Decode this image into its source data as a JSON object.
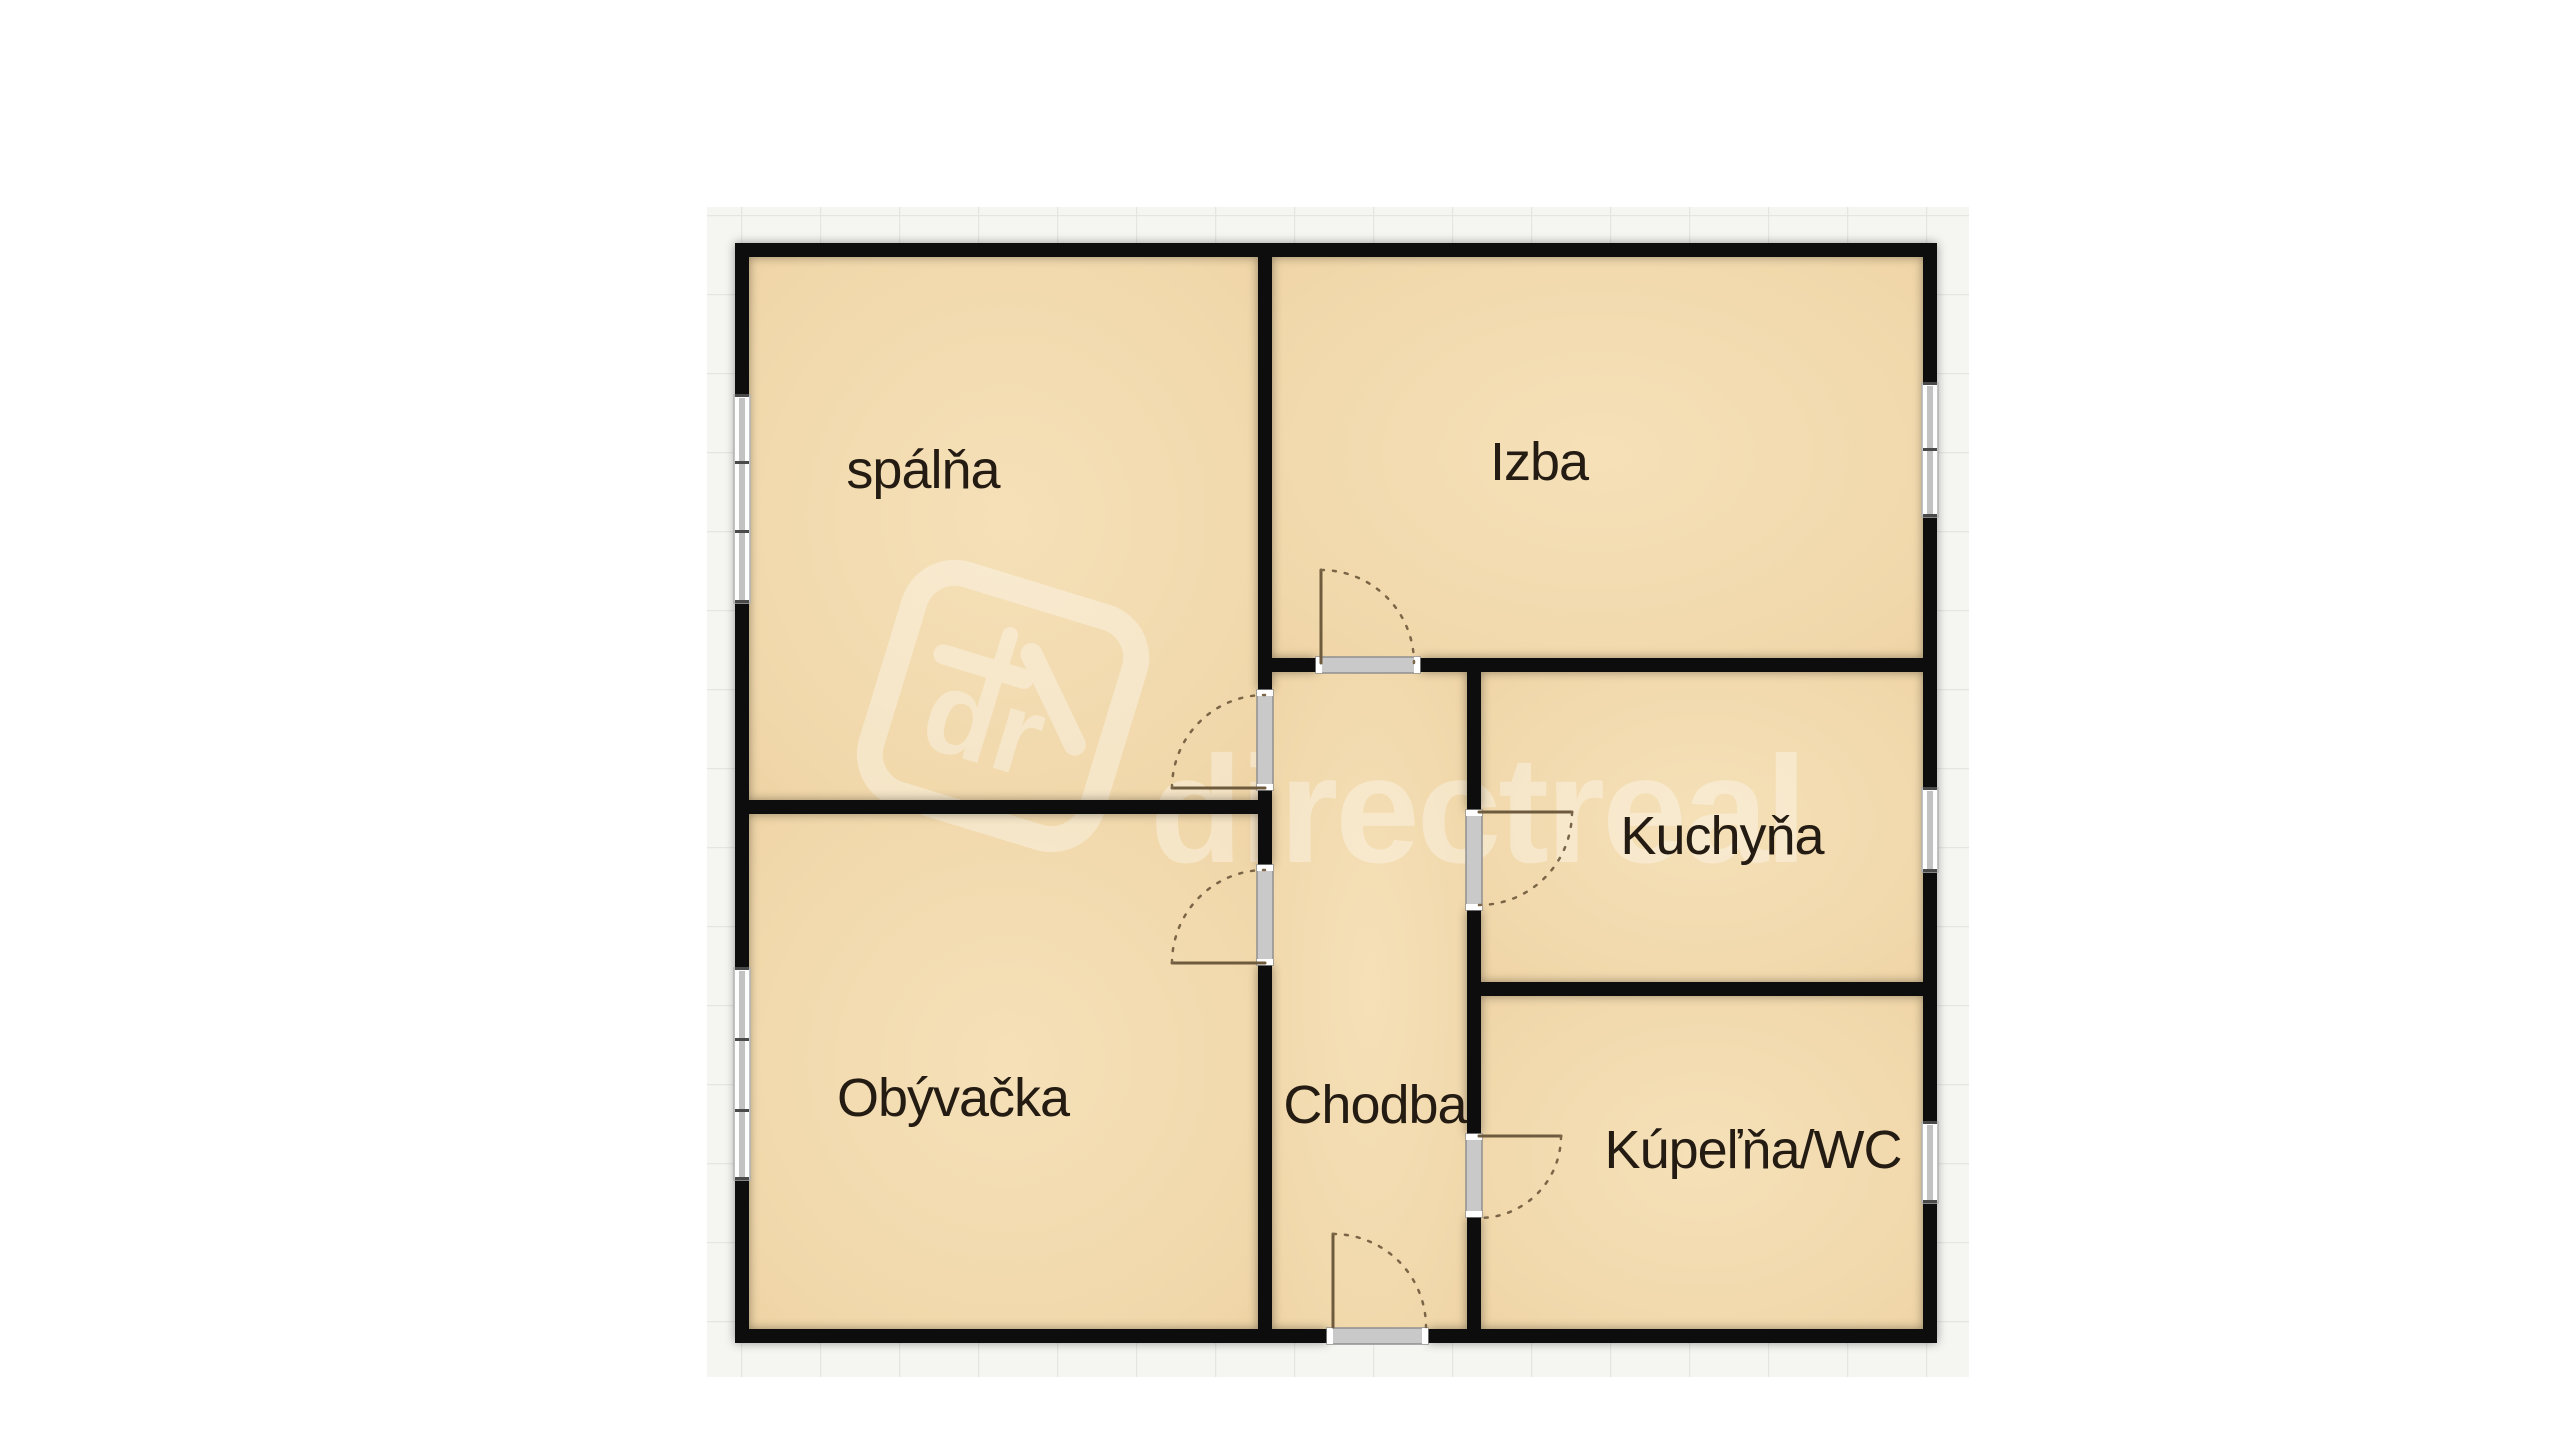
{
  "floorplan": {
    "rooms": [
      {
        "id": "spalna",
        "name": "spálňa"
      },
      {
        "id": "izba",
        "name": "Izba"
      },
      {
        "id": "kuchyna",
        "name": "Kuchyňa"
      },
      {
        "id": "obyvacka",
        "name": "Obývačka"
      },
      {
        "id": "chodba",
        "name": "Chodba"
      },
      {
        "id": "kupelna",
        "name": "Kúpeľňa/WC"
      }
    ],
    "watermark": {
      "logo_monogram": "dr",
      "brand": "directreal"
    },
    "colors": {
      "page_background": "#ffffff",
      "tile_background": "#f5f5f2",
      "tile_grid_line": "#e6e6e1",
      "floor_fill": "#f2d9ac",
      "wall": "#0d0d0d",
      "window_sill": "#c9c9c9",
      "door_line": "#6e5b3e",
      "label_text": "#241c13",
      "watermark": "#ffffff"
    }
  }
}
